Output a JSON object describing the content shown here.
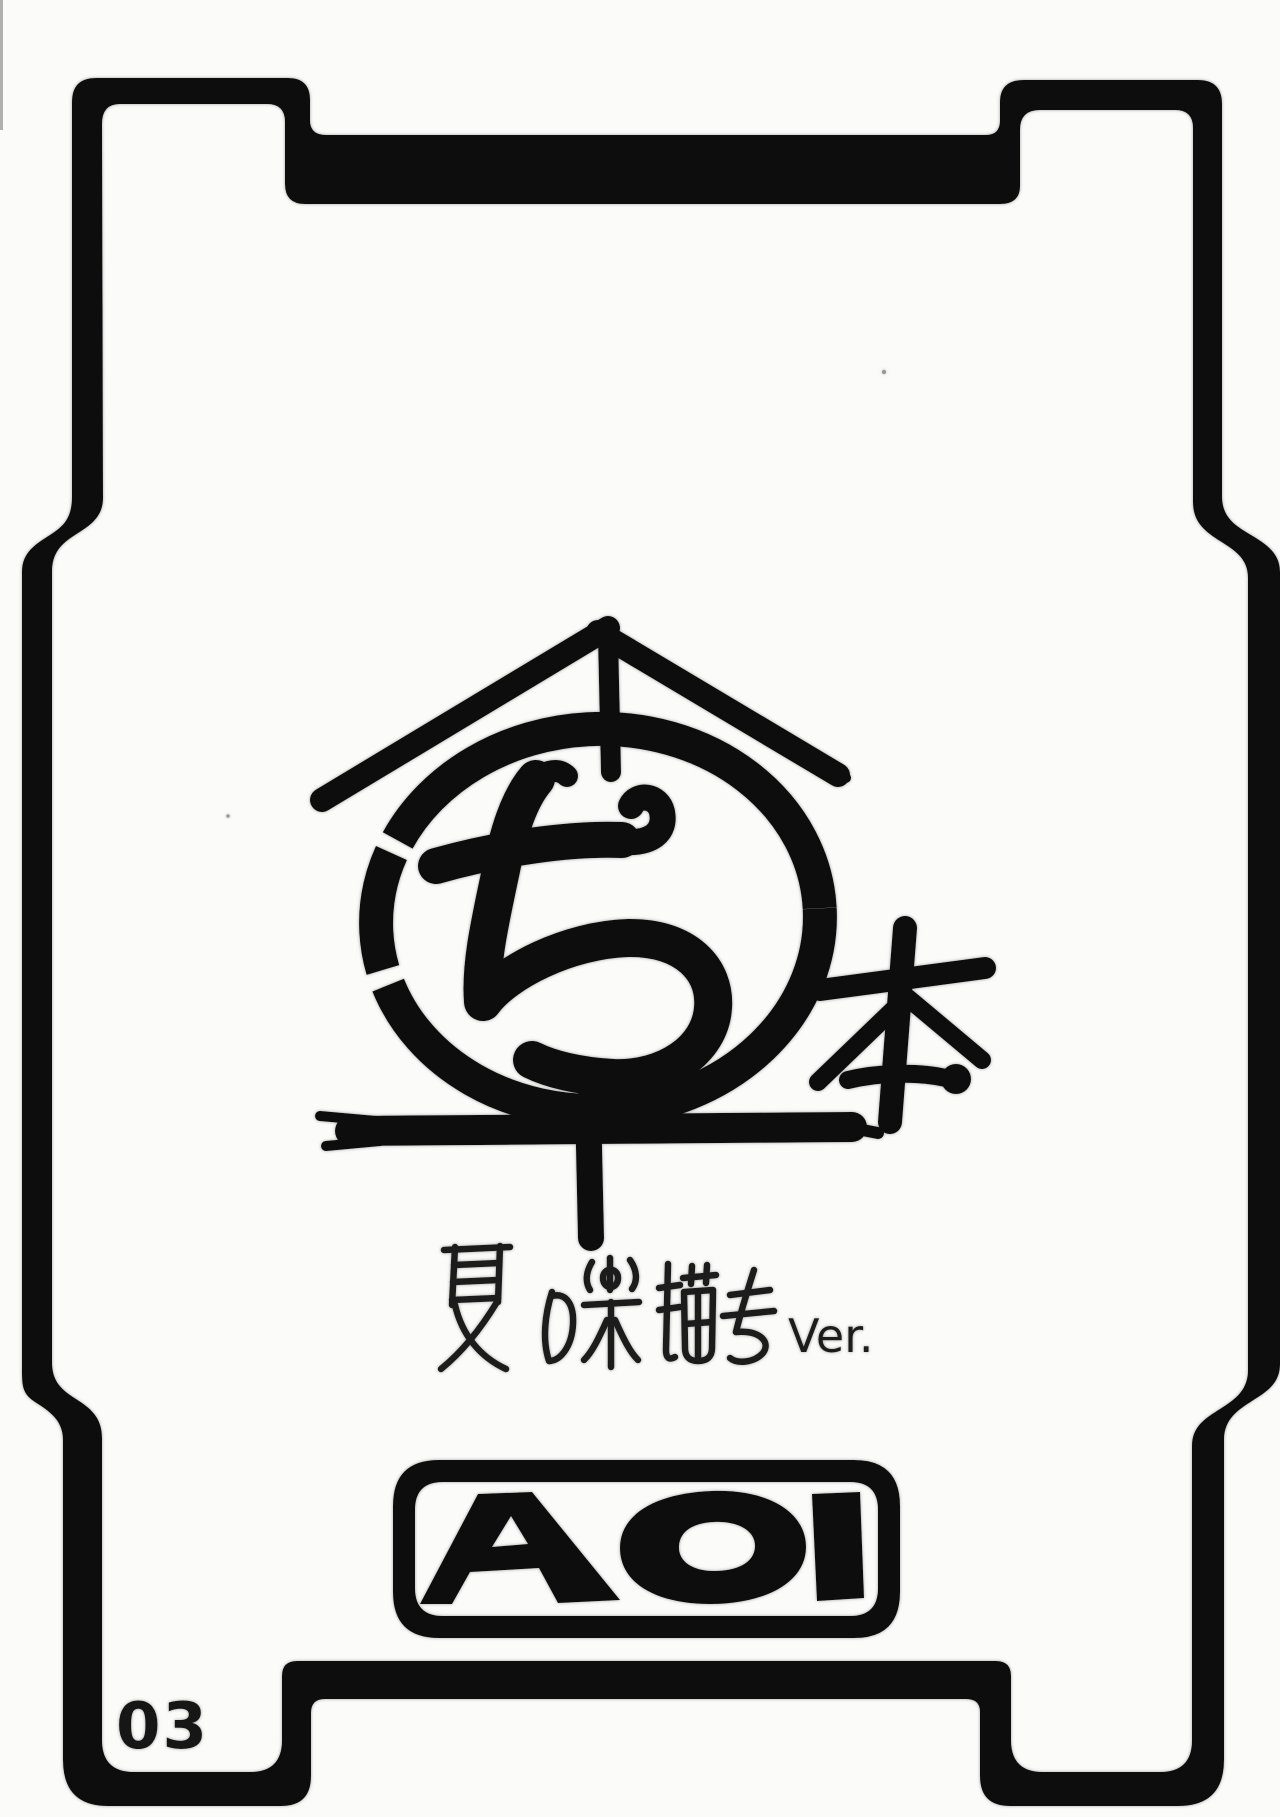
{
  "page": {
    "number": "03",
    "paper_color": "#fbfbfa",
    "ink_color": "#111111",
    "halo_color": "#8f8f8f"
  },
  "title_logo": {
    "circle_char": "ち",
    "book_char": "本",
    "subtitle_kana": "夏の楽描き",
    "subtitle_suffix": "Ver."
  },
  "publisher_badge": {
    "label": "AOI"
  }
}
